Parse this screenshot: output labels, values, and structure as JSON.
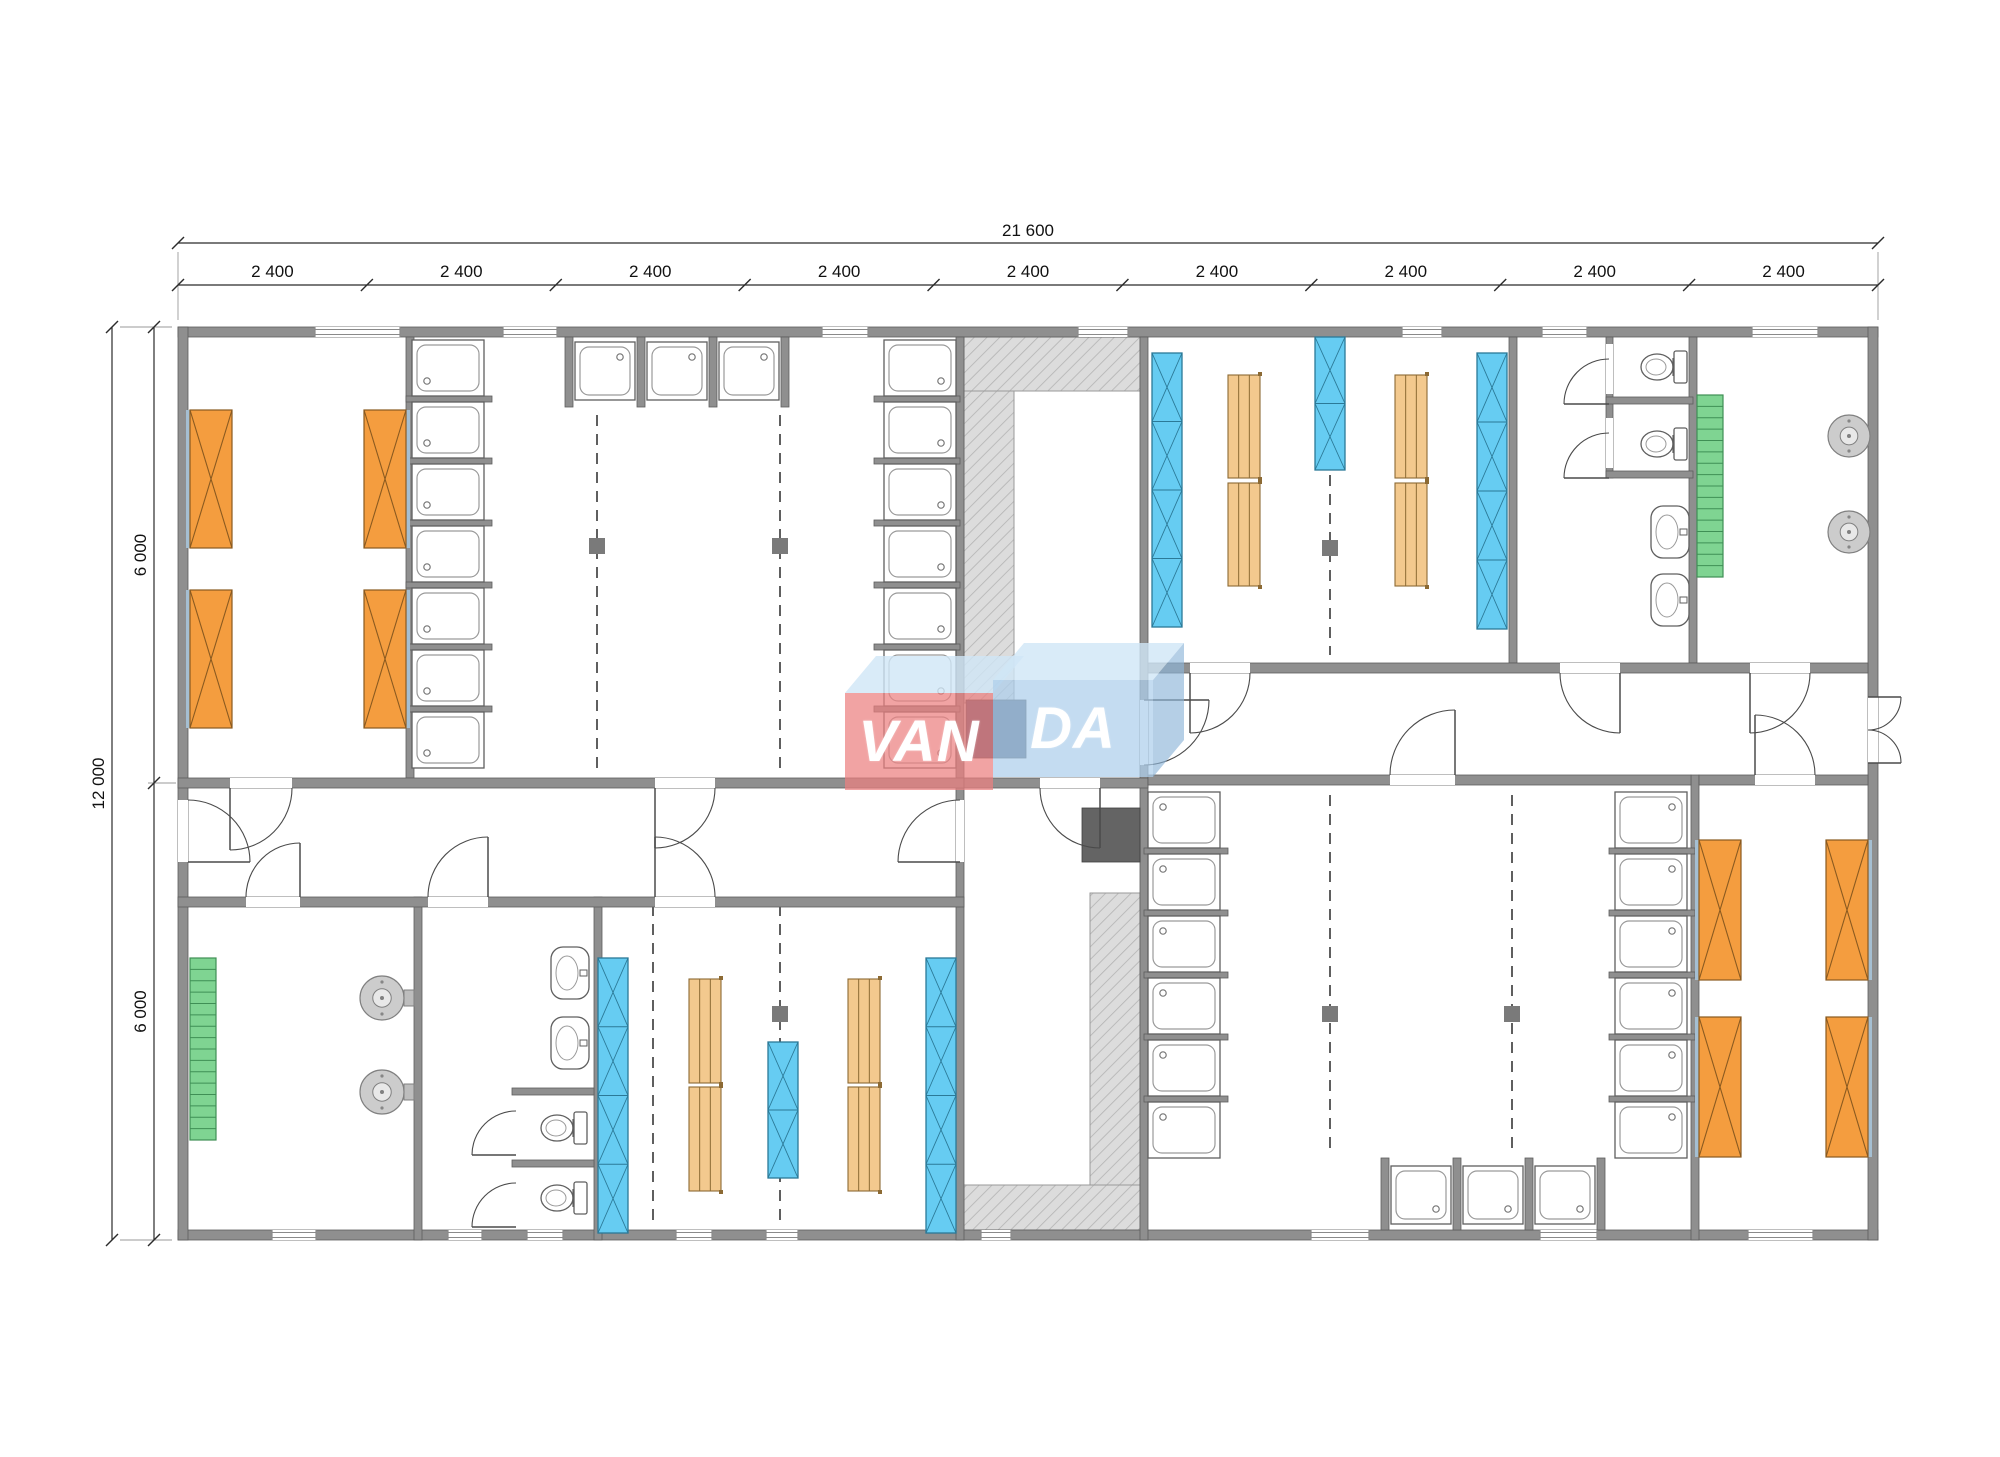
{
  "canvas": {
    "w": 2000,
    "h": 1457,
    "bg": "#ffffff"
  },
  "logo": {
    "van": "VAN",
    "da": "DA",
    "red_face": "rgba(235,128,128,0.72)",
    "blue_face": "rgba(173,206,235,0.72)",
    "top_face": "rgba(208,230,246,0.8)"
  },
  "dimensions": {
    "total_width_label": "21 600",
    "bay_labels": [
      "2 400",
      "2 400",
      "2 400",
      "2 400",
      "2 400",
      "2 400",
      "2 400",
      "2 400",
      "2 400"
    ],
    "total_height_label": "12 000",
    "half_height_labels": [
      "6 000",
      "6 000"
    ]
  },
  "colors": {
    "wall": "#8f8f8f",
    "wall_edge": "#5d5d5d",
    "window_line": "#8a8a8a",
    "hatch_bg": "#dcdcdc",
    "hatch_line": "#b3b3b3",
    "bed": "#f49d3f",
    "bed_edge": "#8a5a20",
    "bed_strip": "#a5bfd2",
    "locker": "#66ccf2",
    "locker_edge": "#2b7997",
    "bench": "#f3c98e",
    "bench_edge": "#8c6a34",
    "radiator": "#7fd492",
    "radiator_edge": "#3f8f55",
    "fixture_edge": "#5f5f5f",
    "tray_inner": "#9a9a9a",
    "round_fill": "#cccccc",
    "dashed": "#5f5f5f",
    "post": "#7a7a7a",
    "door": "#4a4a4a",
    "dim": "#2b2b2b",
    "dim_text": "#111111",
    "ext": "#9a9a9a"
  },
  "plan": {
    "dims": {
      "yTotal": 243,
      "yBays": 285,
      "x0": 178,
      "x1": 1878,
      "xTotal": 112,
      "xHalf": 154,
      "yTop": 327,
      "yMid": 783,
      "yBot": 1240
    },
    "ext_lines": [
      [
        178,
        252,
        178,
        320
      ],
      [
        1878,
        252,
        1878,
        320
      ],
      [
        120,
        327,
        172,
        327
      ],
      [
        120,
        1240,
        172,
        1240
      ],
      [
        148,
        783,
        176,
        783
      ]
    ],
    "walls": [
      [
        178,
        327,
        1700,
        10
      ],
      [
        178,
        1230,
        1700,
        10
      ],
      [
        178,
        327,
        10,
        913
      ],
      [
        1868,
        327,
        10,
        913
      ],
      [
        406,
        337,
        8,
        441
      ],
      [
        956,
        337,
        8,
        441
      ],
      [
        956,
        788,
        8,
        452
      ],
      [
        1140,
        337,
        8,
        903
      ],
      [
        1509,
        337,
        8,
        326
      ],
      [
        1689,
        337,
        8,
        326
      ],
      [
        414,
        897,
        8,
        343
      ],
      [
        594,
        897,
        8,
        343
      ],
      [
        1691,
        775,
        8,
        465
      ],
      [
        178,
        778,
        786,
        10
      ],
      [
        964,
        778,
        184,
        10
      ],
      [
        178,
        897,
        786,
        10
      ],
      [
        1148,
        663,
        720,
        10
      ],
      [
        1148,
        775,
        543,
        10
      ],
      [
        1699,
        775,
        169,
        10
      ],
      [
        1606,
        337,
        7,
        141
      ],
      [
        1606,
        397,
        87,
        7
      ],
      [
        1606,
        471,
        87,
        7
      ],
      [
        512,
        1088,
        82,
        7
      ],
      [
        512,
        1160,
        82,
        7
      ],
      [
        565,
        337,
        8,
        70
      ],
      [
        637,
        337,
        8,
        70
      ],
      [
        709,
        337,
        8,
        70
      ],
      [
        781,
        337,
        8,
        70
      ],
      [
        1381,
        1158,
        8,
        72
      ],
      [
        1453,
        1158,
        8,
        72
      ],
      [
        1525,
        1158,
        8,
        72
      ],
      [
        1597,
        1158,
        8,
        72
      ],
      [
        406,
        396,
        86,
        6
      ],
      [
        406,
        458,
        86,
        6
      ],
      [
        406,
        520,
        86,
        6
      ],
      [
        406,
        582,
        86,
        6
      ],
      [
        406,
        644,
        86,
        6
      ],
      [
        406,
        706,
        86,
        6
      ],
      [
        874,
        396,
        86,
        6
      ],
      [
        874,
        458,
        86,
        6
      ],
      [
        874,
        520,
        86,
        6
      ],
      [
        874,
        582,
        86,
        6
      ],
      [
        874,
        644,
        86,
        6
      ],
      [
        874,
        706,
        86,
        6
      ],
      [
        1144,
        848,
        84,
        6
      ],
      [
        1144,
        910,
        84,
        6
      ],
      [
        1144,
        972,
        84,
        6
      ],
      [
        1144,
        1034,
        84,
        6
      ],
      [
        1144,
        1096,
        84,
        6
      ],
      [
        1609,
        848,
        86,
        6
      ],
      [
        1609,
        910,
        86,
        6
      ],
      [
        1609,
        972,
        86,
        6
      ],
      [
        1609,
        1034,
        86,
        6
      ],
      [
        1609,
        1096,
        86,
        6
      ]
    ],
    "gaps": [
      [
        230,
        778,
        62,
        10
      ],
      [
        655,
        778,
        60,
        10
      ],
      [
        1040,
        778,
        60,
        10
      ],
      [
        246,
        897,
        54,
        10
      ],
      [
        428,
        897,
        60,
        10
      ],
      [
        655,
        897,
        60,
        10
      ],
      [
        1190,
        663,
        60,
        10
      ],
      [
        1560,
        663,
        60,
        10
      ],
      [
        1750,
        663,
        60,
        10
      ],
      [
        1390,
        775,
        65,
        10
      ],
      [
        1755,
        775,
        60,
        10
      ],
      [
        178,
        800,
        10,
        62
      ],
      [
        1868,
        697,
        10,
        66
      ],
      [
        956,
        800,
        8,
        62
      ],
      [
        1140,
        700,
        8,
        65
      ],
      [
        1606,
        344,
        7,
        50
      ],
      [
        1606,
        418,
        7,
        50
      ],
      [
        512,
        1107,
        7,
        48
      ],
      [
        512,
        1179,
        7,
        44
      ]
    ],
    "windows_top": {
      "y": 327,
      "items": [
        [
          315,
          85
        ],
        [
          503,
          54
        ],
        [
          822,
          46
        ],
        [
          1078,
          50
        ],
        [
          1402,
          40
        ],
        [
          1542,
          45
        ],
        [
          1752,
          66
        ]
      ]
    },
    "windows_bottom": {
      "y": 1230,
      "items": [
        [
          272,
          44
        ],
        [
          448,
          34
        ],
        [
          527,
          36
        ],
        [
          676,
          36
        ],
        [
          766,
          32
        ],
        [
          981,
          30
        ],
        [
          1311,
          58
        ],
        [
          1540,
          57
        ],
        [
          1748,
          65
        ]
      ]
    },
    "hatches": [
      [
        964,
        337,
        176,
        54
      ],
      [
        964,
        391,
        50,
        312
      ],
      [
        1090,
        893,
        50,
        292
      ],
      [
        964,
        1185,
        176,
        45
      ]
    ],
    "stoves": [
      [
        966,
        700,
        60,
        58,
        "#4e5a74"
      ],
      [
        1082,
        808,
        58,
        54,
        "#646464"
      ]
    ],
    "dashed": [
      [
        597,
        415,
        353
      ],
      [
        780,
        415,
        353
      ],
      [
        1330,
        475,
        180
      ],
      [
        653,
        905,
        320
      ],
      [
        780,
        905,
        320
      ],
      [
        1330,
        795,
        357
      ],
      [
        1512,
        795,
        357
      ]
    ],
    "posts": [
      [
        597,
        546
      ],
      [
        780,
        546
      ],
      [
        1330,
        548
      ],
      [
        780,
        1014
      ],
      [
        1330,
        1014
      ],
      [
        1512,
        1014
      ]
    ],
    "tray_cols": [
      [
        412,
        340,
        72,
        7,
        "bl"
      ],
      [
        884,
        340,
        72,
        7,
        "br"
      ],
      [
        1148,
        792,
        72,
        6,
        "tl"
      ],
      [
        1615,
        792,
        72,
        6,
        "tr"
      ]
    ],
    "trays": [
      [
        575,
        342,
        60,
        58,
        "tr"
      ],
      [
        647,
        342,
        60,
        58,
        "tr"
      ],
      [
        719,
        342,
        60,
        58,
        "tr"
      ],
      [
        1391,
        1166,
        60,
        58,
        "br"
      ],
      [
        1463,
        1166,
        60,
        58,
        "br"
      ],
      [
        1535,
        1166,
        60,
        58,
        "br"
      ]
    ],
    "beds": [
      [
        190,
        410,
        42,
        138,
        "l"
      ],
      [
        190,
        590,
        42,
        138,
        "l"
      ],
      [
        364,
        410,
        42,
        138,
        "r"
      ],
      [
        364,
        590,
        42,
        138,
        "r"
      ],
      [
        1699,
        840,
        42,
        140,
        "l"
      ],
      [
        1699,
        1017,
        42,
        140,
        "l"
      ],
      [
        1826,
        840,
        42,
        140,
        "r"
      ],
      [
        1826,
        1017,
        42,
        140,
        "r"
      ]
    ],
    "lockers": [
      [
        1152,
        353,
        30,
        274,
        4
      ],
      [
        1315,
        337,
        30,
        133,
        2
      ],
      [
        1477,
        353,
        30,
        276,
        4
      ],
      [
        598,
        958,
        30,
        275,
        4
      ],
      [
        768,
        1042,
        30,
        136,
        2
      ],
      [
        926,
        958,
        30,
        275,
        4
      ]
    ],
    "benches": [
      [
        1228,
        375,
        32,
        103
      ],
      [
        1228,
        483,
        32,
        103
      ],
      [
        1395,
        375,
        32,
        103
      ],
      [
        1395,
        483,
        32,
        103
      ],
      [
        689,
        979,
        32,
        104
      ],
      [
        689,
        1087,
        32,
        104
      ],
      [
        848,
        979,
        32,
        104
      ],
      [
        848,
        1087,
        32,
        104
      ]
    ],
    "radiators": [
      [
        1697,
        395,
        26,
        182
      ],
      [
        190,
        958,
        26,
        182
      ]
    ],
    "toilets": [
      [
        1689,
        367
      ],
      [
        1689,
        444
      ],
      [
        589,
        1128
      ],
      [
        589,
        1198
      ]
    ],
    "basins": [
      [
        1651,
        506,
        38,
        52
      ],
      [
        1651,
        574,
        38,
        52
      ],
      [
        551,
        947,
        38,
        52
      ],
      [
        551,
        1017,
        38,
        52
      ]
    ],
    "rounds": [
      [
        382,
        998,
        22
      ],
      [
        382,
        1092,
        22
      ],
      [
        1849,
        436,
        21
      ],
      [
        1849,
        532,
        21
      ]
    ],
    "mounts": [
      [
        404,
        990,
        10,
        16
      ],
      [
        404,
        1084,
        10,
        16
      ],
      [
        1858,
        428,
        10,
        16
      ],
      [
        1858,
        524,
        10,
        16
      ]
    ],
    "doors": [
      [
        230,
        788,
        62,
        90,
        0,
        0
      ],
      [
        655,
        788,
        60,
        90,
        0,
        0
      ],
      [
        1100,
        788,
        60,
        90,
        180,
        1
      ],
      [
        300,
        897,
        54,
        270,
        180,
        0
      ],
      [
        488,
        897,
        60,
        270,
        180,
        0
      ],
      [
        655,
        897,
        60,
        270,
        0,
        1
      ],
      [
        188,
        862,
        62,
        0,
        270,
        0
      ],
      [
        960,
        862,
        62,
        180,
        270,
        1
      ],
      [
        1144,
        700,
        65,
        0,
        90,
        1
      ],
      [
        1190,
        673,
        60,
        90,
        0,
        0
      ],
      [
        1620,
        673,
        60,
        90,
        180,
        1
      ],
      [
        1750,
        673,
        60,
        90,
        0,
        0
      ],
      [
        1455,
        775,
        65,
        270,
        180,
        0
      ],
      [
        1755,
        775,
        60,
        270,
        0,
        1
      ],
      [
        1868,
        697,
        33,
        0,
        90,
        1
      ],
      [
        1868,
        763,
        33,
        0,
        270,
        0
      ],
      [
        1609,
        404,
        45,
        180,
        270,
        1
      ],
      [
        1609,
        478,
        45,
        180,
        270,
        1
      ],
      [
        516,
        1155,
        44,
        180,
        270,
        1
      ],
      [
        516,
        1227,
        44,
        180,
        270,
        1
      ]
    ]
  }
}
